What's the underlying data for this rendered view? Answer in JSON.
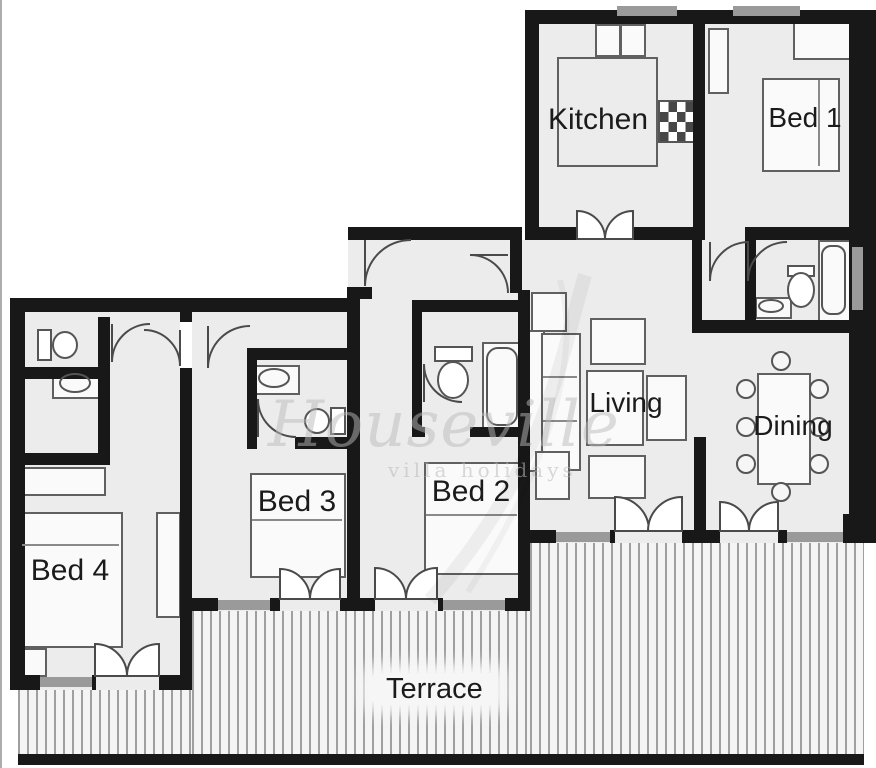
{
  "plan": {
    "rooms": {
      "kitchen": "Kitchen",
      "bed1": "Bed 1",
      "living": "Living",
      "dining": "Dining",
      "bed2": "Bed 2",
      "bed3": "Bed 3",
      "bed4": "Bed 4",
      "terrace": "Terrace"
    },
    "watermark": {
      "brand": "Houseville",
      "tagline": "villa holidays"
    },
    "colors": {
      "wall": "#181818",
      "floor": "#ececec",
      "window": "#9a9a9a",
      "terrace_stripe": "#9f9f9f"
    }
  }
}
